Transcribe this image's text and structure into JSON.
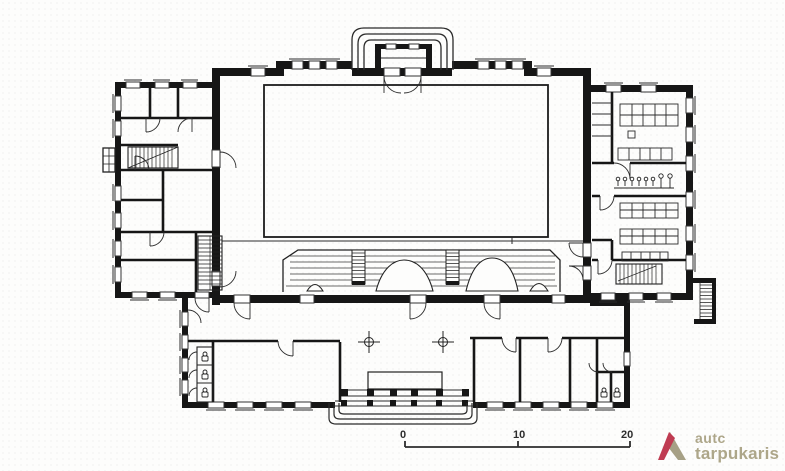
{
  "page": {
    "paper_color": "#fdfdfc",
    "ink_color": "#161616",
    "thin_line_color": "#2b2b2b"
  },
  "drawing": {
    "kind": "architectural-floor-plan-scan",
    "features": [
      "central-hall-with-inner-court",
      "tribune-with-stairs",
      "left-wing-rooms",
      "right-wing-classrooms",
      "bottom-wing-with-portico",
      "top-entrance-steps",
      "toilet-stalls",
      "coat-hook-corridor"
    ]
  },
  "scale_bar": {
    "labels": [
      "0",
      "10",
      "20"
    ]
  },
  "logo": {
    "line1": "autc",
    "line2": "tarpukaris",
    "text_color": "#ada689",
    "triangle_red": "#bf3b51",
    "triangle_olive": "#a6a085"
  }
}
